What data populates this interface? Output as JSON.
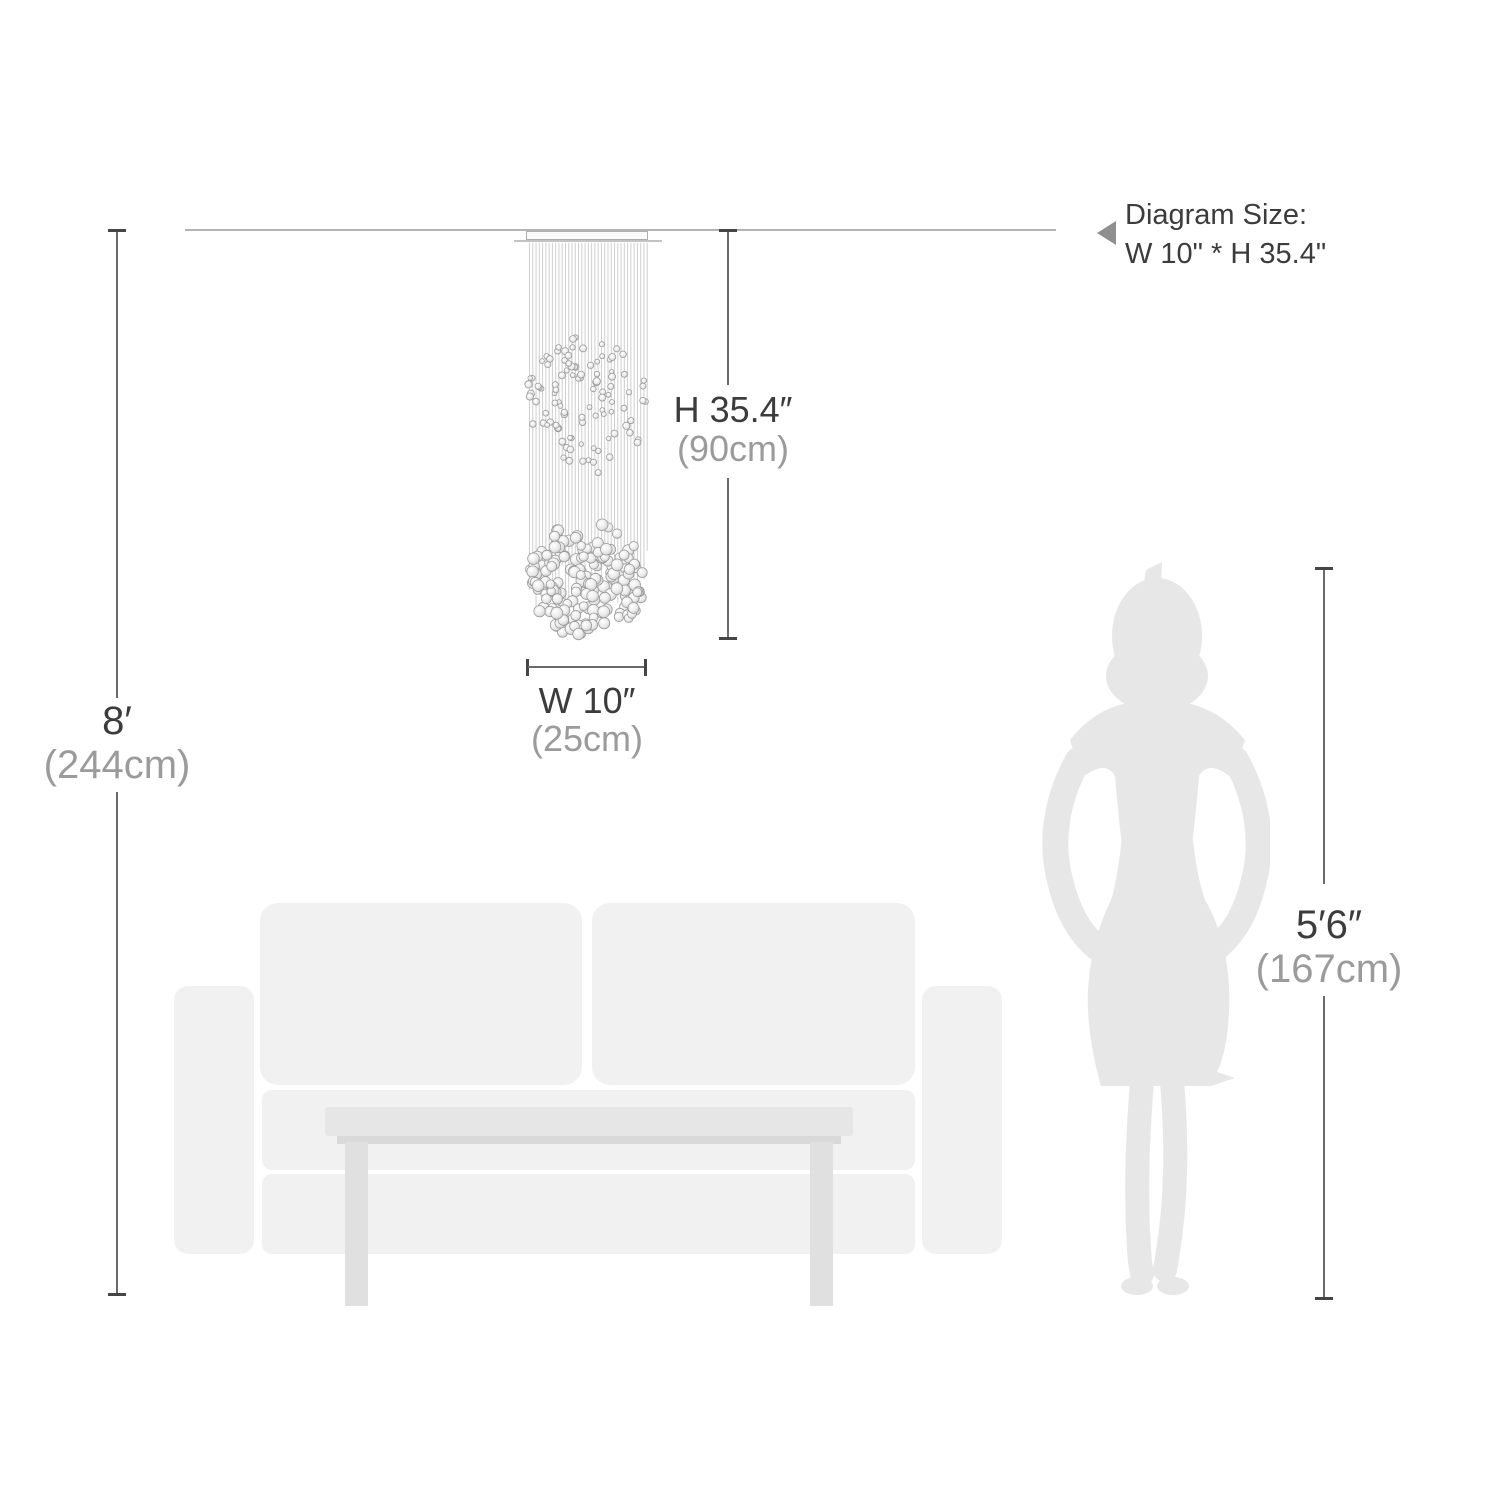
{
  "note": {
    "line1": "Diagram Size:",
    "line2": "W 10\" * H 35.4\"",
    "icon": "triangle-left-icon"
  },
  "dimensions": {
    "fixture_height": {
      "imperial": "H 35.4″",
      "metric": "(90cm)"
    },
    "fixture_width": {
      "imperial": "W 10″",
      "metric": "(25cm)"
    },
    "ceiling_height": {
      "imperial": "8′",
      "metric": "(244cm)"
    },
    "person_height": {
      "imperial": "5′6″",
      "metric": "(167cm)"
    }
  },
  "colors": {
    "text_dark": "#3c3c3c",
    "text_gray": "#9b9b9b",
    "dim_line": "#6a6a6a",
    "tick": "#454545",
    "ceiling_line": "#b5b5b5",
    "silhouette": "#e7e7e7",
    "sofa": "#f1f1f1",
    "table_top": "#e6e6e6",
    "table_lip": "#d9d9d9",
    "table_leg": "#e0e0e0",
    "string": "#cfcfcf",
    "ball_stroke": "#9a9a9a"
  }
}
